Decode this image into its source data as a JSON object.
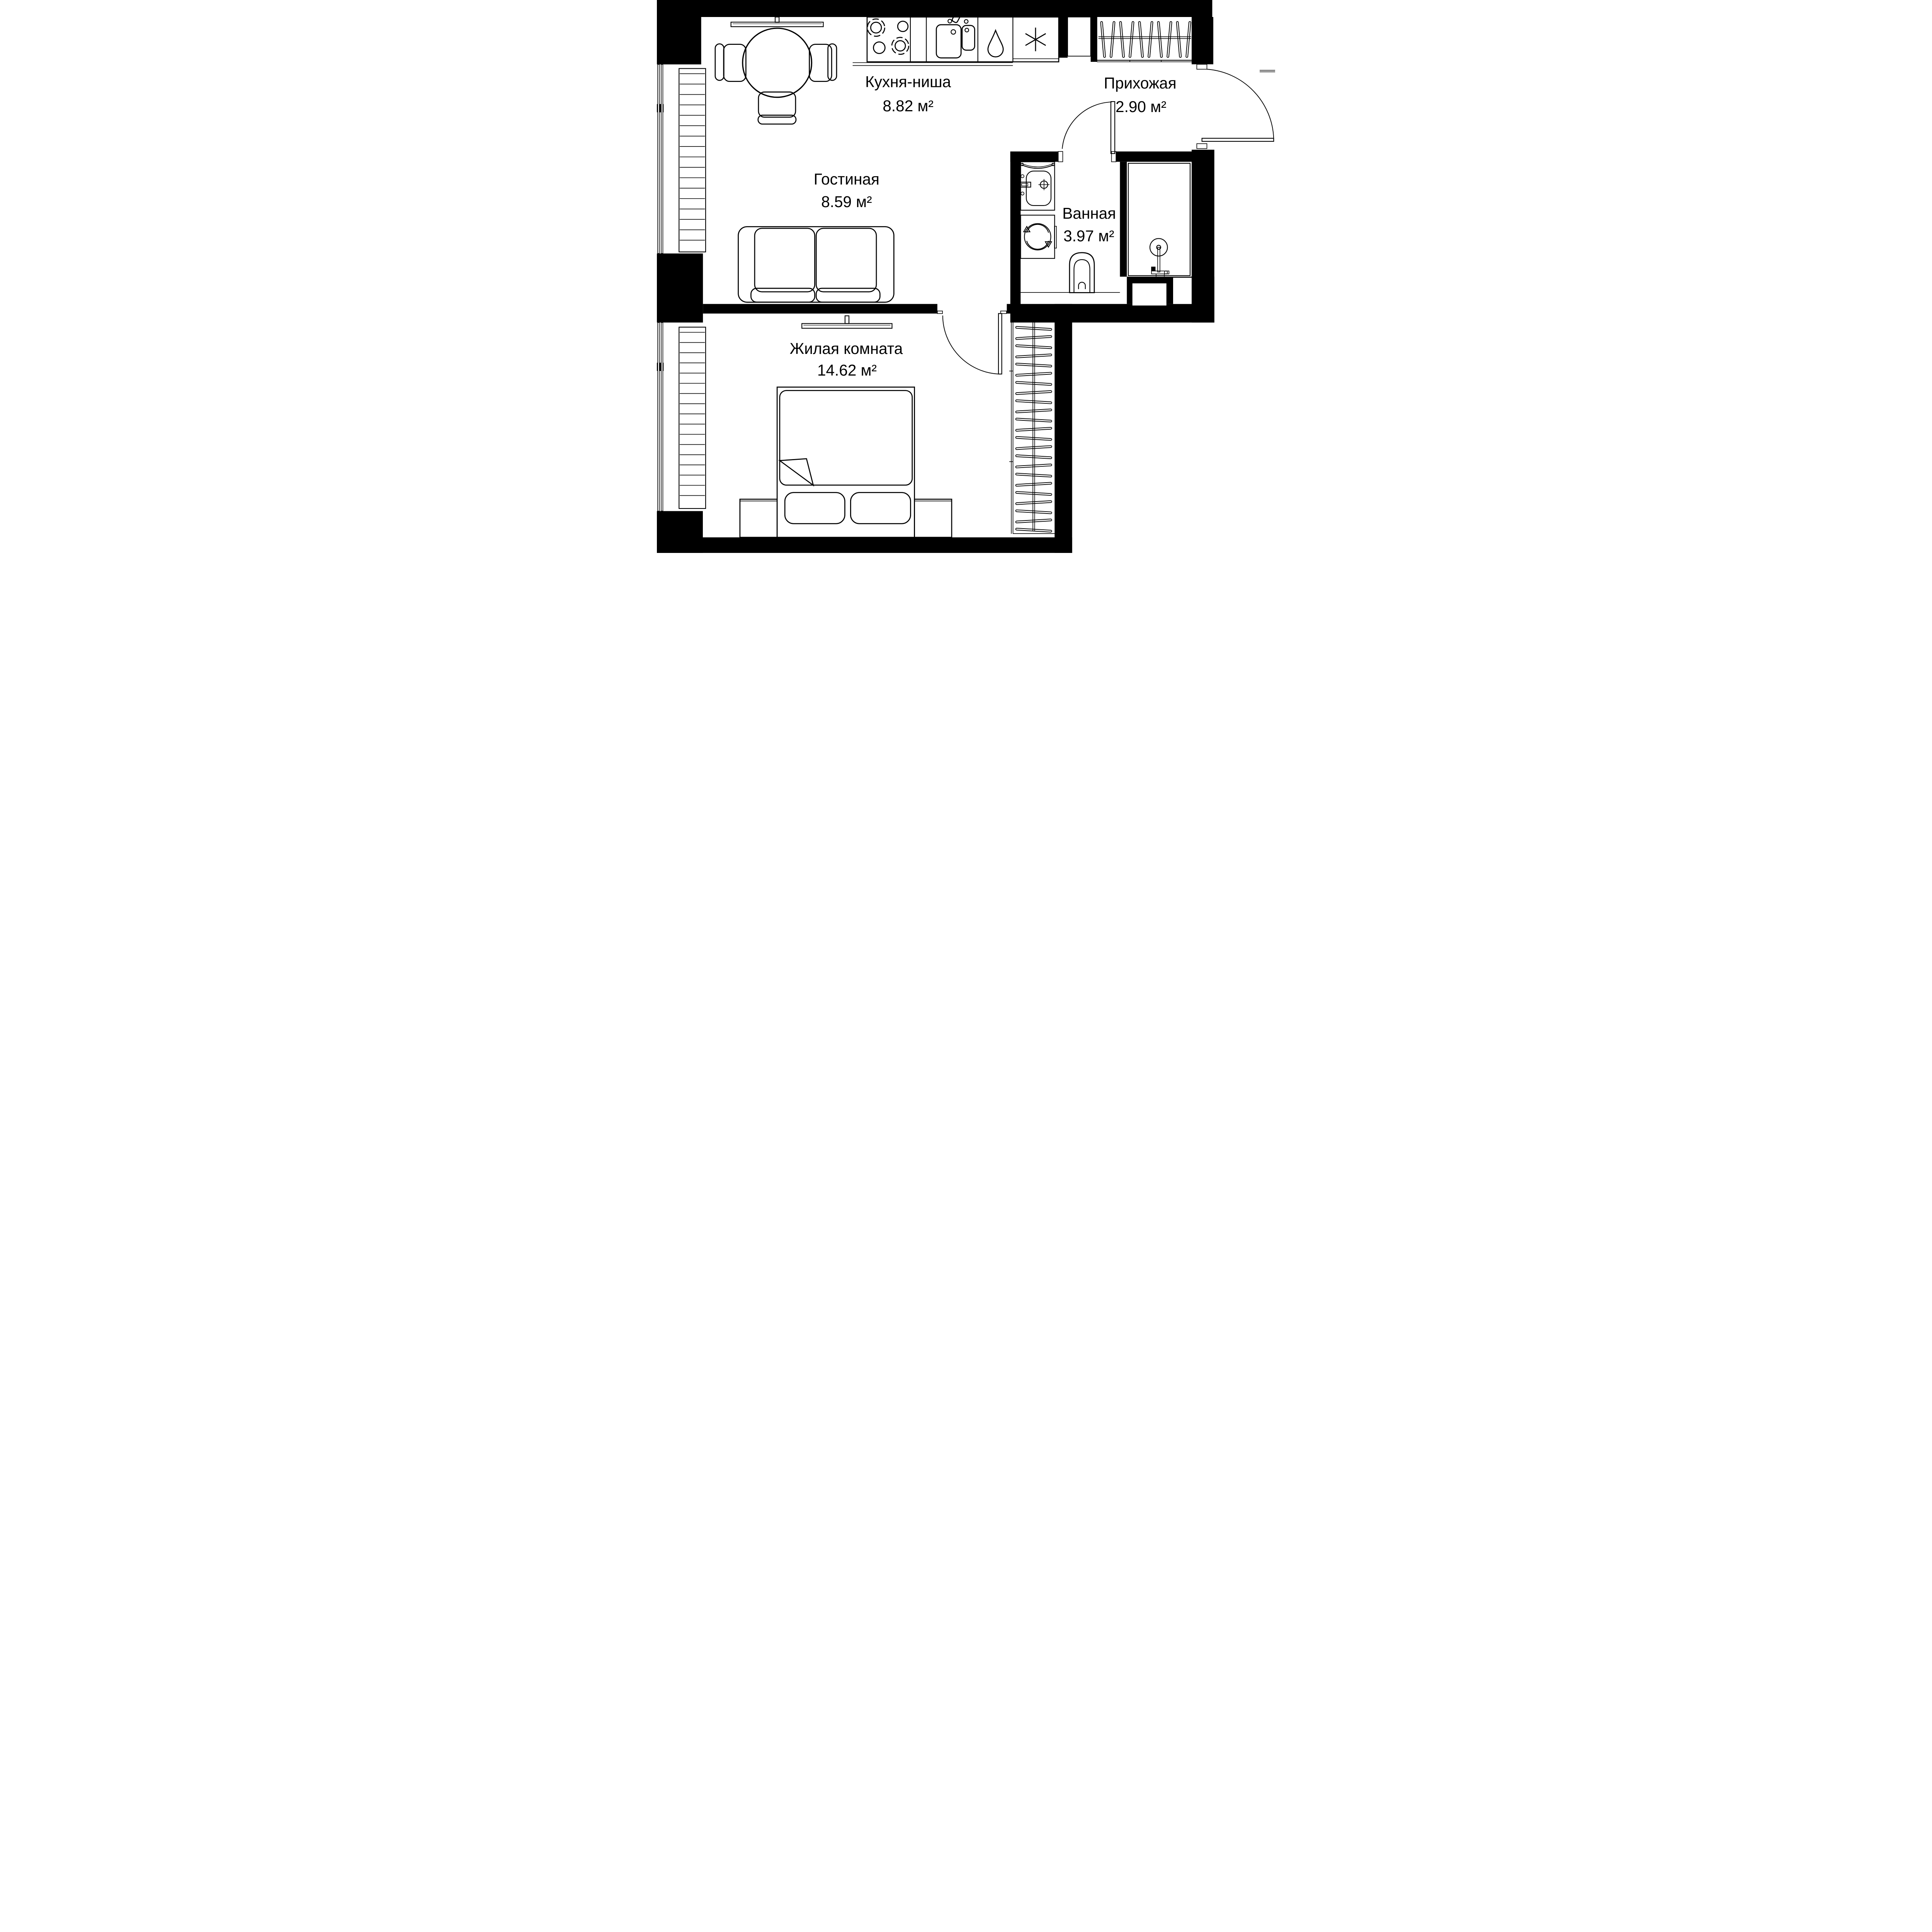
{
  "colors": {
    "line": "#000000",
    "background": "#ffffff"
  },
  "rooms": [
    {
      "name": "Кухня-ниша",
      "area": "8.82 м²"
    },
    {
      "name": "Прихожая",
      "area": "2.90 м²"
    },
    {
      "name": "Гостиная",
      "area": "8.59 м²"
    },
    {
      "name": "Ванная",
      "area": "3.97 м²"
    },
    {
      "name": "Жилая комната",
      "area": "14.62 м²"
    }
  ],
  "icons": [
    "stove-burners-icon",
    "kitchen-sink-icon",
    "dishwasher-drop-icon",
    "fridge-snowflake-icon",
    "coat-hanger-rail-icon",
    "entrance-door-icon",
    "interior-door-icon",
    "dining-table-icon",
    "chair-icon",
    "tv-console-icon",
    "sofa-icon",
    "bathroom-sink-icon",
    "washing-machine-icon",
    "toilet-icon",
    "shower-icon",
    "bed-icon",
    "nightstand-icon",
    "radiator-icon",
    "window-icon",
    "wardrobe-hangers-icon"
  ]
}
